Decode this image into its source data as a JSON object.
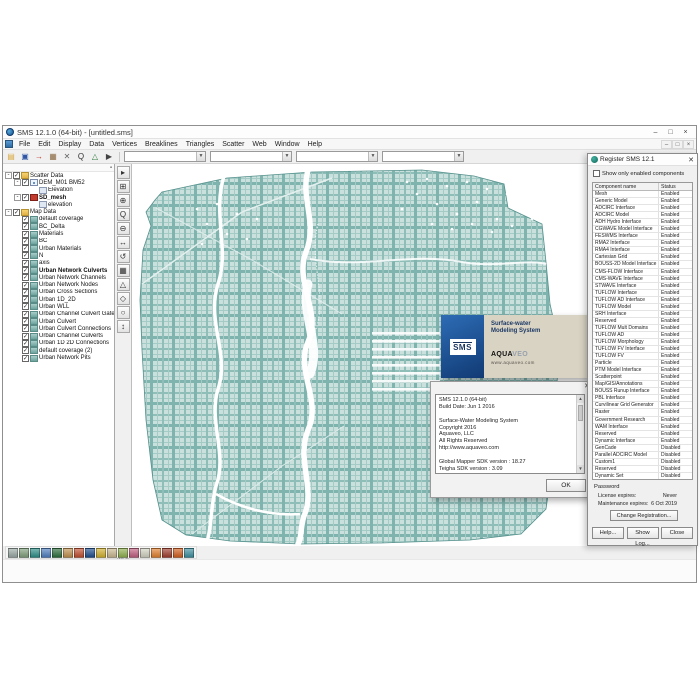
{
  "window": {
    "title": "SMS 12.1.0 (64-bit) - [untitled.sms]",
    "controls": [
      {
        "name": "minimize",
        "glyph": "–"
      },
      {
        "name": "maximize",
        "glyph": "□"
      },
      {
        "name": "close",
        "glyph": "×"
      }
    ],
    "child_controls": [
      {
        "name": "child-minimize",
        "glyph": "–"
      },
      {
        "name": "child-restore",
        "glyph": "□"
      },
      {
        "name": "child-close",
        "glyph": "×"
      }
    ]
  },
  "menu": {
    "items": [
      "File",
      "Edit",
      "Display",
      "Data",
      "Vertices",
      "Breaklines",
      "Triangles",
      "Scatter",
      "Web",
      "Window",
      "Help"
    ]
  },
  "toolbar": {
    "buttons": [
      {
        "name": "open-project-icon",
        "glyph": "▤",
        "color": "#d9a93f"
      },
      {
        "name": "save-icon",
        "glyph": "▣",
        "color": "#2f57a5"
      },
      {
        "name": "import-icon",
        "glyph": "→",
        "color": "#c23b2e"
      },
      {
        "name": "package-icon",
        "glyph": "▦",
        "color": "#8a6a42"
      },
      {
        "name": "cut-icon",
        "glyph": "✕",
        "color": "#666666"
      },
      {
        "name": "zoom-icon",
        "glyph": "Q",
        "color": "#333333"
      },
      {
        "name": "plot-icon",
        "glyph": "△",
        "color": "#2f7a3f"
      },
      {
        "name": "select-icon",
        "glyph": "▶",
        "color": "#444444"
      }
    ],
    "combos": [
      "",
      "",
      "",
      ""
    ]
  },
  "tree": {
    "items": [
      {
        "label": "Scatter Data",
        "level": 0,
        "icon": "folder",
        "check": true,
        "exp": true
      },
      {
        "label": "DEM_M01 BM52",
        "level": 1,
        "icon": "scatter",
        "check": true,
        "exp": true
      },
      {
        "label": "Elevation",
        "level": 2,
        "icon": "dataset"
      },
      {
        "label": "SD_mesh",
        "level": 1,
        "icon": "mesh",
        "check": true,
        "exp": true,
        "bold": true
      },
      {
        "label": "elevation",
        "level": 2,
        "icon": "dataset"
      },
      {
        "label": "Map Data",
        "level": 0,
        "icon": "folder",
        "check": true,
        "exp": true
      },
      {
        "label": "default coverage",
        "level": 1,
        "icon": "coverage",
        "check": true
      },
      {
        "label": "BC_Delta",
        "level": 1,
        "icon": "coverage",
        "check": true
      },
      {
        "label": "Materials",
        "level": 1,
        "icon": "coverage",
        "check": true
      },
      {
        "label": "BC",
        "level": 1,
        "icon": "coverage",
        "check": true
      },
      {
        "label": "Urban Materials",
        "level": 1,
        "icon": "coverage",
        "check": true
      },
      {
        "label": "N",
        "level": 1,
        "icon": "coverage",
        "check": true
      },
      {
        "label": "axis",
        "level": 1,
        "icon": "coverage",
        "check": true
      },
      {
        "label": "Urban Network Culverts",
        "level": 1,
        "icon": "coverage",
        "check": true,
        "bold": true
      },
      {
        "label": "Urban Network Channels",
        "level": 1,
        "icon": "coverage",
        "check": true
      },
      {
        "label": "Urban Network Nodes",
        "level": 1,
        "icon": "coverage",
        "check": true
      },
      {
        "label": "Urban Cross Sections",
        "level": 1,
        "icon": "coverage",
        "check": true
      },
      {
        "label": "Urban 1D_2D",
        "level": 1,
        "icon": "coverage",
        "check": true
      },
      {
        "label": "Urban WLL",
        "level": 1,
        "icon": "coverage",
        "check": true
      },
      {
        "label": "Urban Channel Culvert Gates",
        "level": 1,
        "icon": "coverage",
        "check": true
      },
      {
        "label": "Urban Culvert",
        "level": 1,
        "icon": "coverage",
        "check": true
      },
      {
        "label": "Urban Culvert Connections",
        "level": 1,
        "icon": "coverage",
        "check": true
      },
      {
        "label": "Urban Channel Culverts",
        "level": 1,
        "icon": "coverage",
        "check": true
      },
      {
        "label": "Urban 1D 2D Connections",
        "level": 1,
        "icon": "coverage",
        "check": true
      },
      {
        "label": "default coverage (2)",
        "level": 1,
        "icon": "coverage",
        "check": true
      },
      {
        "label": "Urban Network Pits",
        "level": 1,
        "icon": "coverage",
        "check": true
      }
    ]
  },
  "palette": {
    "tools": [
      {
        "name": "select-tool",
        "glyph": "▸"
      },
      {
        "name": "select-area-tool",
        "glyph": "⊞"
      },
      {
        "name": "create-point-tool",
        "glyph": "⊕"
      },
      {
        "name": "zoom-tool",
        "glyph": "Q"
      },
      {
        "name": "zoom-out-tool",
        "glyph": "⊖"
      },
      {
        "name": "pan-tool",
        "glyph": "↔"
      },
      {
        "name": "rotate-tool",
        "glyph": "↺"
      },
      {
        "name": "frame-tool",
        "glyph": "▦"
      },
      {
        "name": "contour-tool",
        "glyph": "△"
      },
      {
        "name": "vertex-tool",
        "glyph": "◇"
      },
      {
        "name": "node-tool",
        "glyph": "○"
      },
      {
        "name": "measure-tool",
        "glyph": "↕"
      }
    ]
  },
  "splash": {
    "product": "SMS",
    "tagline1": "Surface-water",
    "tagline2": "Modeling System",
    "brand_a": "AQUA",
    "brand_b": "VEO",
    "url": "www.aquaveo.com"
  },
  "about": {
    "lines": [
      "SMS 12.1.0 (64-bit)",
      "Build Date: Jun 1 2016",
      "",
      "Surface-Water Modeling System",
      "Copyright 2016",
      "Aquaveo, LLC",
      "All Rights Reserved",
      "http://www.aquaveo.com",
      "",
      "Global Mapper SDK version :  18.27",
      "Teigha SDK version :  3.09"
    ],
    "ok": "OK"
  },
  "register": {
    "title": "Register SMS 12.1",
    "filter_label": "Show only enabled components",
    "col_component": "Component name",
    "col_status": "Status",
    "components": [
      {
        "name": "Mesh",
        "status": "Enabled"
      },
      {
        "name": "Generic Model",
        "status": "Enabled"
      },
      {
        "name": "ADCIRC Interface",
        "status": "Enabled"
      },
      {
        "name": "ADCIRC Model",
        "status": "Enabled"
      },
      {
        "name": "ADH Hydro Interface",
        "status": "Enabled"
      },
      {
        "name": "CGWAVE Model Interface",
        "status": "Enabled"
      },
      {
        "name": "FESWMS Interface",
        "status": "Enabled"
      },
      {
        "name": "RMA2 Interface",
        "status": "Enabled"
      },
      {
        "name": "RMA4 Interface",
        "status": "Enabled"
      },
      {
        "name": "Cartesian Grid",
        "status": "Enabled"
      },
      {
        "name": "BOUSS-2D Model Interface",
        "status": "Enabled"
      },
      {
        "name": "CMS-FLOW Interface",
        "status": "Enabled"
      },
      {
        "name": "CMS-WAVE Interface",
        "status": "Enabled"
      },
      {
        "name": "STWAVE Interface",
        "status": "Enabled"
      },
      {
        "name": "TUFLOW Interface",
        "status": "Enabled"
      },
      {
        "name": "TUFLOW AD Interface",
        "status": "Enabled"
      },
      {
        "name": "TUFLOW Model",
        "status": "Enabled"
      },
      {
        "name": "SRH Interface",
        "status": "Enabled"
      },
      {
        "name": "Reserved",
        "status": "Enabled"
      },
      {
        "name": "TUFLOW Mult Domains",
        "status": "Enabled"
      },
      {
        "name": "TUFLOW AD",
        "status": "Enabled"
      },
      {
        "name": "TUFLOW Morphology",
        "status": "Enabled"
      },
      {
        "name": "TUFLOW FV Interface",
        "status": "Enabled"
      },
      {
        "name": "TUFLOW FV",
        "status": "Enabled"
      },
      {
        "name": "Particle",
        "status": "Enabled"
      },
      {
        "name": "PTM Model Interface",
        "status": "Enabled"
      },
      {
        "name": "Scatterpoint",
        "status": "Enabled"
      },
      {
        "name": "Map/GIS/Annotations",
        "status": "Enabled"
      },
      {
        "name": "BOUSS Runup Interface",
        "status": "Enabled"
      },
      {
        "name": "PBL Interface",
        "status": "Enabled"
      },
      {
        "name": "Curvilinear Grid Generator",
        "status": "Enabled"
      },
      {
        "name": "Raster",
        "status": "Enabled"
      },
      {
        "name": "Government Research",
        "status": "Enabled"
      },
      {
        "name": "WAM Interface",
        "status": "Enabled"
      },
      {
        "name": "Reserved",
        "status": "Enabled"
      },
      {
        "name": "Dynamic Interface",
        "status": "Enabled"
      },
      {
        "name": "GenCade",
        "status": "Disabled"
      },
      {
        "name": "Parallel ADCIRC Model",
        "status": "Disabled"
      },
      {
        "name": "Custom1",
        "status": "Disabled"
      },
      {
        "name": "Reserved",
        "status": "Disabled"
      },
      {
        "name": "Dynamic Set",
        "status": "Disabled"
      }
    ],
    "password_label": "Password",
    "license_label": "License expires:",
    "license_value": "Never",
    "maintenance_label": "Maintenance expires:",
    "maintenance_value": "6 Oct 2019",
    "change_button": "Change Registration...",
    "help_button": "Help...",
    "log_button": "Show Log...",
    "close_button": "Close"
  },
  "modules": {
    "icons": [
      {
        "name": "mesh-module-icon",
        "color": "#9aa8a4"
      },
      {
        "name": "scatter-module-icon",
        "color": "#7f9f7c"
      },
      {
        "name": "map-module-icon",
        "color": "#2f8f88"
      },
      {
        "name": "cartesian-grid-module-icon",
        "color": "#4f7fbf"
      },
      {
        "name": "curvilinear-grid-module-icon",
        "color": "#2f6f3f"
      },
      {
        "name": "quadtree-module-icon",
        "color": "#c09050"
      },
      {
        "name": "raster-module-icon",
        "color": "#c05030"
      },
      {
        "name": "gis-module-icon",
        "color": "#204f8f"
      },
      {
        "name": "annotations-module-icon",
        "color": "#d0b030"
      },
      {
        "name": "grid-1d-module-icon",
        "color": "#c8b890"
      },
      {
        "name": "xsec-1d-module-icon",
        "color": "#90b050"
      },
      {
        "name": "river-module-icon",
        "color": "#c06080"
      },
      {
        "name": "drawing-module-icon",
        "color": "#d0d0c0"
      },
      {
        "name": "particle-module-icon",
        "color": "#e08030"
      },
      {
        "name": "spectral-module-icon",
        "color": "#a04030"
      },
      {
        "name": "ugrid-module-icon",
        "color": "#d06020"
      },
      {
        "name": "time-series-module-icon",
        "color": "#4090a0"
      }
    ]
  },
  "status": {
    "value": "30.0"
  }
}
